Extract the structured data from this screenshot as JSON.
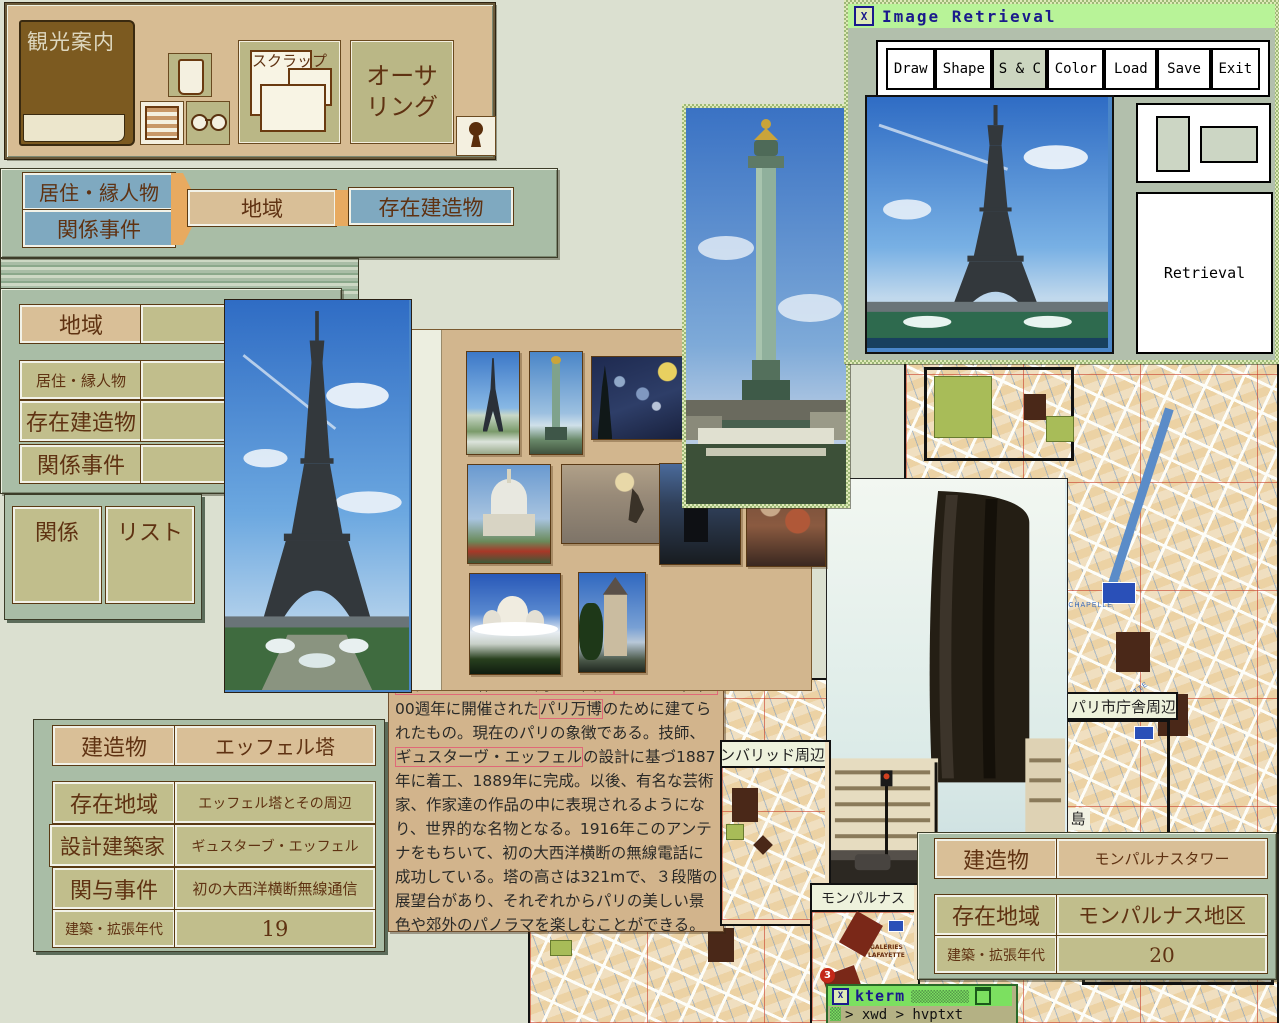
{
  "toolbar": {
    "book_label": "観光案内",
    "scrap_label": "スクラップ",
    "authoring_line1": "オーサ",
    "authoring_line2": "リング"
  },
  "nav_bar": {
    "residents": "居住・縁人物",
    "events": "関係事件",
    "region": "地域",
    "buildings": "存在建造物"
  },
  "left_panel": {
    "region": "地域",
    "residents": "居住・縁人物",
    "buildings": "存在建造物",
    "events": "関係事件"
  },
  "relation_panel": {
    "relation": "関係",
    "list": "リスト"
  },
  "image_retrieval": {
    "title": "Image Retrieval",
    "buttons": [
      "Draw",
      "Shape",
      "S & C",
      "Color",
      "Load",
      "Save",
      "Exit"
    ],
    "selected": "S & C",
    "retrieval": "Retrieval"
  },
  "eiffel_table": {
    "rows": [
      {
        "label": "建造物",
        "value": "エッフェル塔"
      },
      {
        "label": "存在地域",
        "value": "エッフェル塔とその周辺"
      },
      {
        "label": "設計建築家",
        "value": "ギュスターブ・エッフェル"
      },
      {
        "label": "関与事件",
        "value": "初の大西洋横断無線通信"
      },
      {
        "label": "建築・拡張年代",
        "value": "19"
      }
    ]
  },
  "montparnasse_table": {
    "rows": [
      {
        "label": "建造物",
        "value": "モンパルナスタワー"
      },
      {
        "label": "存在地域",
        "value": "モンパルナス地区"
      },
      {
        "label": "建築・拡張年代",
        "value": "20"
      }
    ]
  },
  "text_window": {
    "lines": [
      [
        {
          "t": "エッフェル塔"
        }
      ],
      [
        {
          "t": "エッフェル塔とその周辺地図。"
        },
        {
          "t": "フランス革命1"
        }
      ],
      [
        {
          "t": "00週年に開催された"
        },
        {
          "t": "パリ万博"
        },
        {
          "t": "のために建てら"
        }
      ],
      [
        {
          "t": "れたもの。現在のパリの象徴である。技師、"
        }
      ],
      [
        {
          "t": "ギュスターヴ・エッフェル"
        },
        {
          "t": "の設計に基づ1887"
        }
      ],
      [
        {
          "t": "年に着工、1889年に完成。以後、有名な芸術"
        }
      ],
      [
        {
          "t": "家、作家達の作品の中に表現されるようにな"
        }
      ],
      [
        {
          "t": "り、世界的な名物となる。1916年このアンテ"
        }
      ],
      [
        {
          "t": "ナをもちいて、初の大西洋横断の無線電話に"
        }
      ],
      [
        {
          "t": "成功している。塔の高さは321mで、３段階の"
        }
      ],
      [
        {
          "t": "展望台があり、それぞれからパリの美しい景"
        }
      ],
      [
        {
          "t": "色や郊外のパノラマを楽しむことができる。"
        }
      ]
    ]
  },
  "maps": {
    "city_hall_label": "パリ市庁舎周辺",
    "invalides_label": "アンバリッド周辺",
    "montparnasse_label": "モンパルナス",
    "street1": "BOULEVARD  DE  LA  CHAPELLE",
    "street2": "LAFAYETTE",
    "store1": "GALERIES",
    "store2": "LAFAYETTE",
    "badge3": "3",
    "badge5": "5",
    "island": "島"
  },
  "kterm": {
    "title": "kterm",
    "prompt_line": "> xwd > hvptxt"
  }
}
